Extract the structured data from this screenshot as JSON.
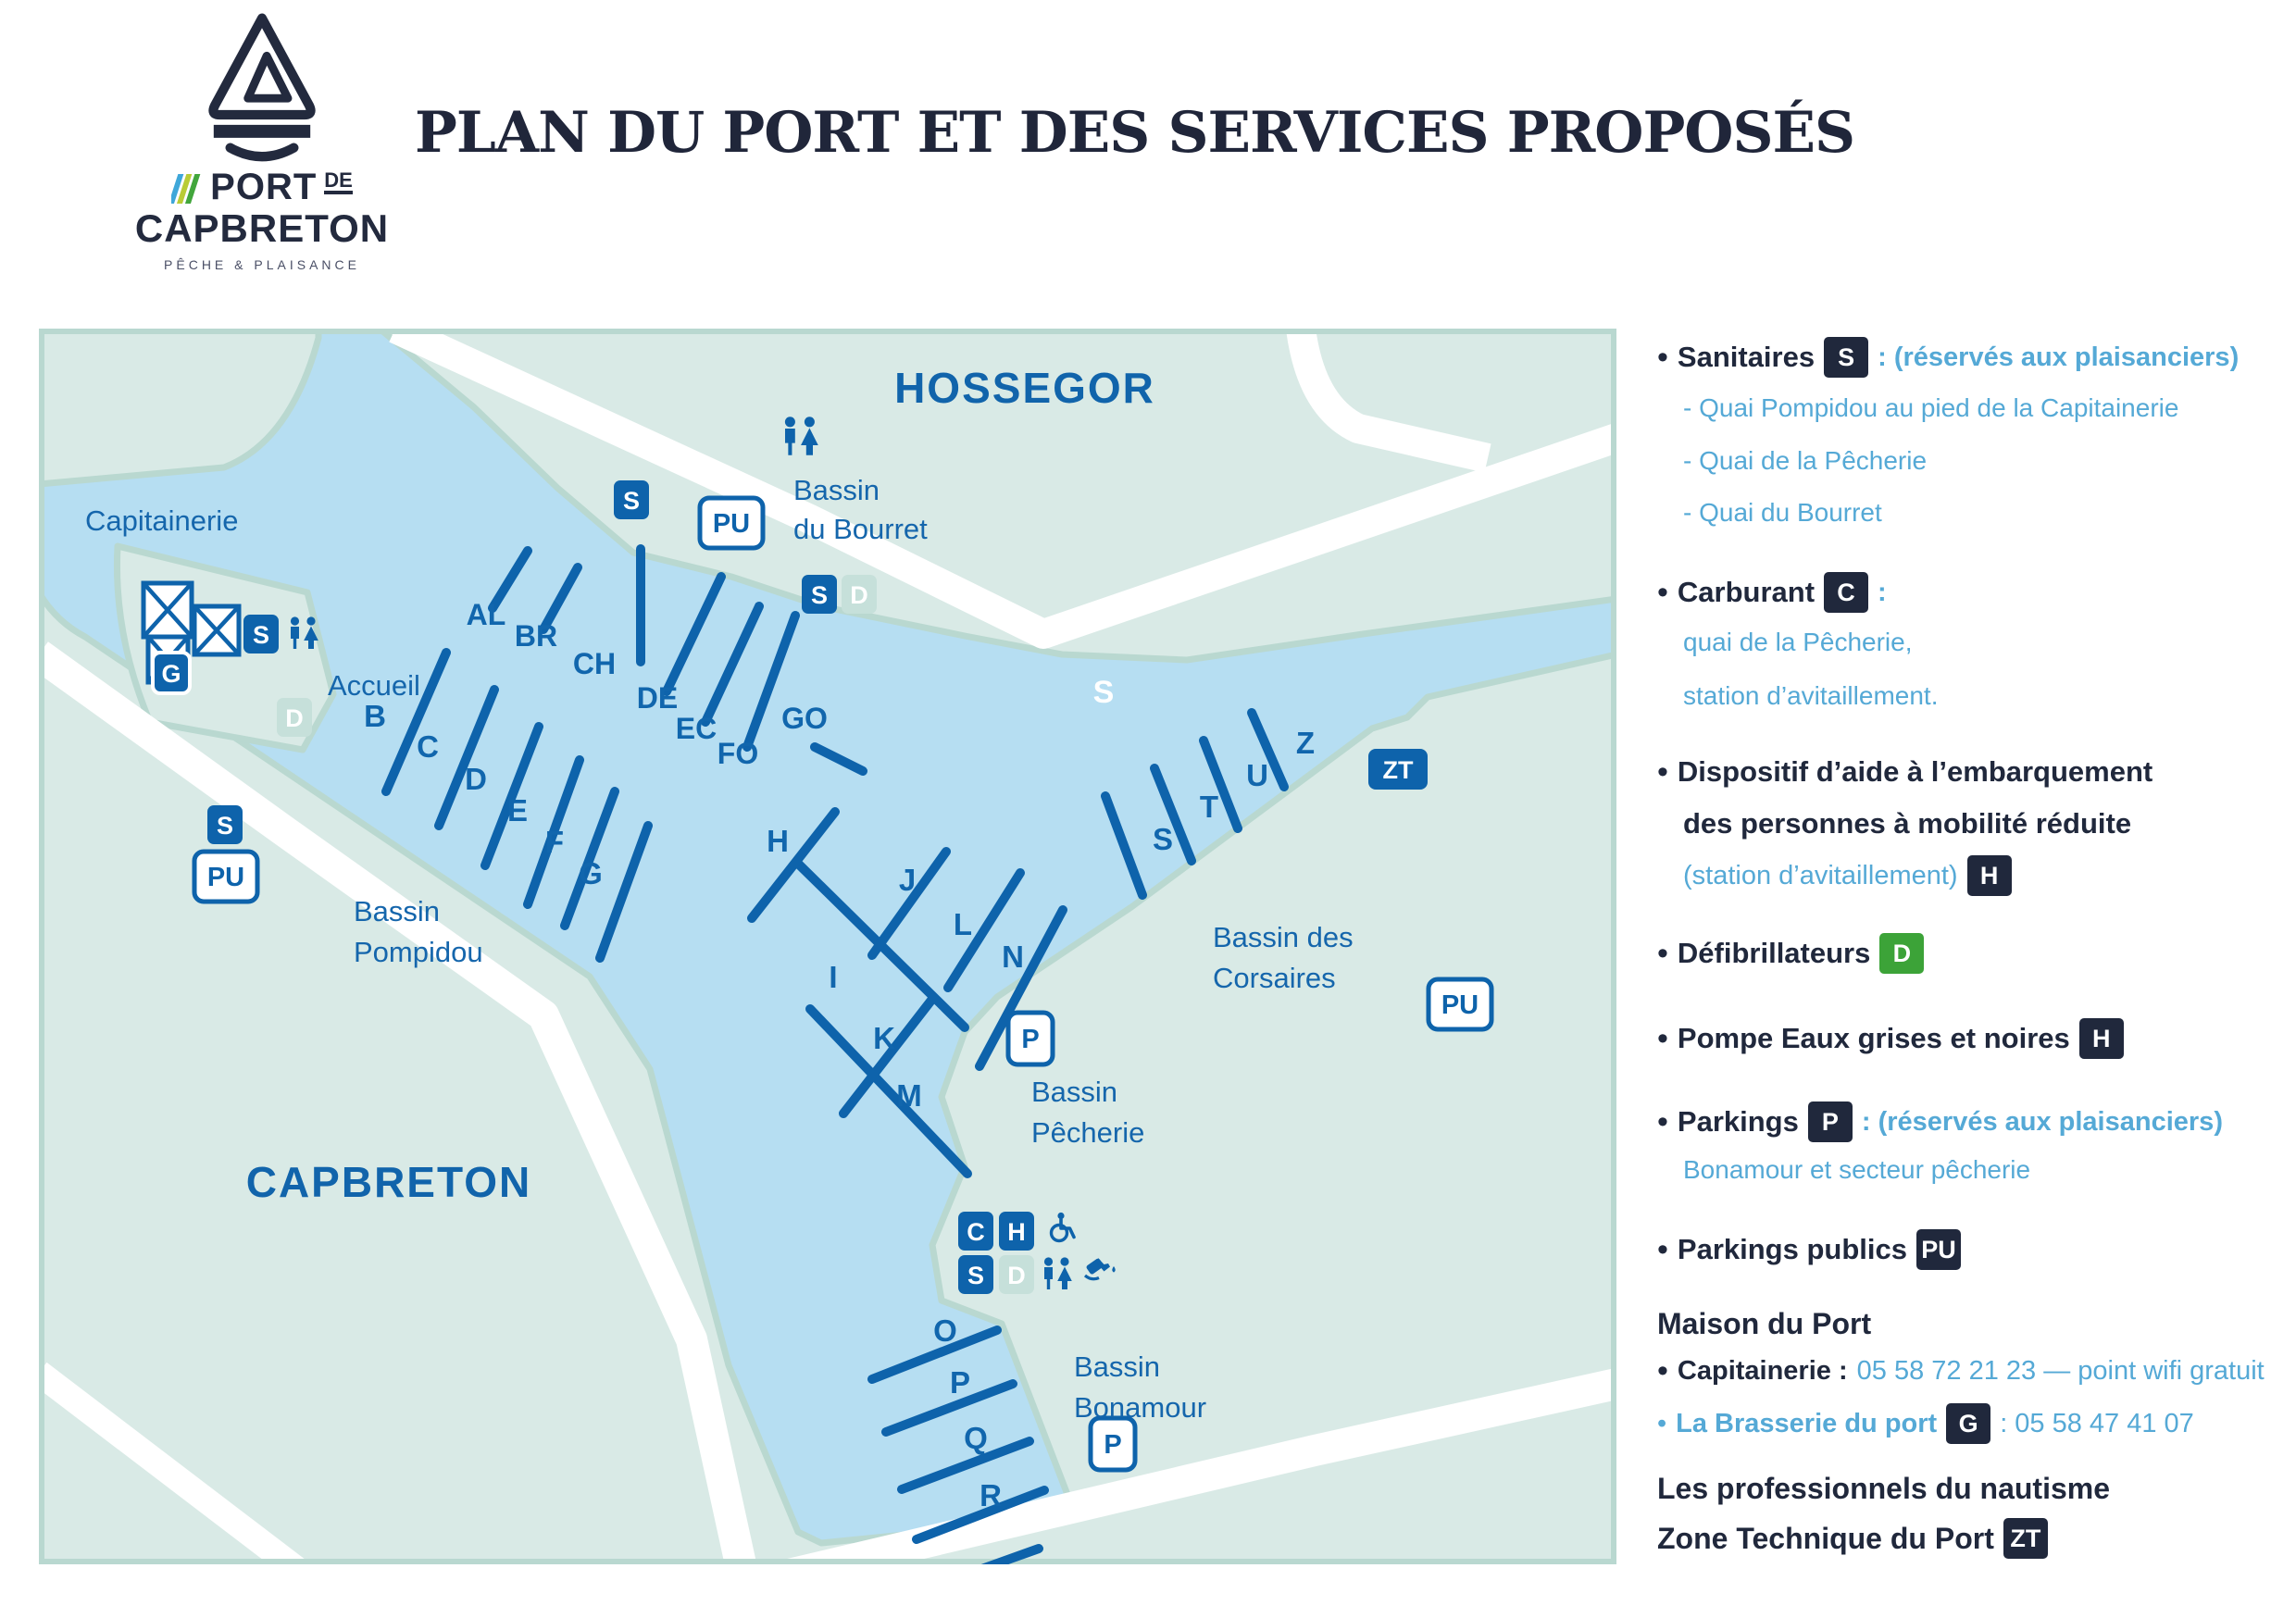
{
  "logo": {
    "brand_top": "PORT",
    "brand_de": "DE",
    "brand_bottom": "CAPBRETON",
    "tagline": "PÊCHE & PLAISANCE"
  },
  "title": "PLAN DU PORT ET DES SERVICES PROPOSÉS",
  "map": {
    "cities": {
      "hossegor": "HOSSEGOR",
      "capbreton": "CAPBRETON"
    },
    "labels": {
      "capitainerie": "Capitainerie",
      "accueil": "Accueil",
      "bourret1": "Bassin",
      "bourret2": "du Bourret",
      "pompidou1": "Bassin",
      "pompidou2": "Pompidou",
      "pecherie1": "Bassin",
      "pecherie2": "Pêcherie",
      "corsaires1": "Bassin des",
      "corsaires2": "Corsaires",
      "bonamour1": "Bassin",
      "bonamour2": "Bonamour",
      "channel_marker": "S"
    },
    "badges": {
      "s": "S",
      "d": "D",
      "c": "C",
      "h": "H",
      "g": "G",
      "p": "P",
      "pu": "PU",
      "zt": "ZT"
    },
    "pontoons": {
      "al": "AL",
      "br": "BR",
      "ch": "CH",
      "de": "DE",
      "ec": "EC",
      "fo": "FO",
      "go": "GO",
      "b": "B",
      "c": "C",
      "d": "D",
      "e": "E",
      "f": "F",
      "g": "G",
      "h": "H",
      "i": "I",
      "j": "J",
      "k": "K",
      "l": "L",
      "m": "M",
      "n": "N",
      "o": "O",
      "p": "P",
      "q": "Q",
      "r": "R",
      "s": "S",
      "t": "T",
      "u": "U",
      "z": "Z"
    }
  },
  "legend": {
    "sanitaires": {
      "label": "Sanitaires",
      "badge": "S",
      "suffix": ": (réservés aux plaisanciers)",
      "subs": [
        "- Quai Pompidou au pied de la Capitainerie",
        "- Quai de la Pêcherie",
        "- Quai du Bourret"
      ]
    },
    "carburant": {
      "label": "Carburant",
      "badge": "C",
      "suffix": ":",
      "subs": [
        "quai de la Pêcherie,",
        "station d’avitaillement."
      ]
    },
    "pmr": {
      "line1": "Dispositif d’aide à l’embarquement",
      "line2": "des personnes à mobilité réduite",
      "line3": "(station d’avitaillement)",
      "badge": "H"
    },
    "defib": {
      "label": "Défibrillateurs",
      "badge": "D"
    },
    "pompe": {
      "label": "Pompe Eaux grises et noires",
      "badge": "H"
    },
    "parkings": {
      "label": "Parkings",
      "badge": "P",
      "suffix": ": (réservés aux plaisanciers)",
      "sub": "Bonamour et secteur pêcherie"
    },
    "parkings_publics": {
      "label": "Parkings publics",
      "badge": "PU"
    },
    "maison": {
      "title": "Maison du Port",
      "cap_label": "Capitainerie :",
      "cap_value": "05 58 72 21 23 — point wifi gratuit",
      "bras_label": "La Brasserie du port",
      "bras_badge": "G",
      "bras_value": ": 05 58 47 41 07"
    },
    "pros": "Les professionnels du nautisme",
    "zone": {
      "label": "Zone Technique du Port",
      "badge": "ZT"
    }
  }
}
